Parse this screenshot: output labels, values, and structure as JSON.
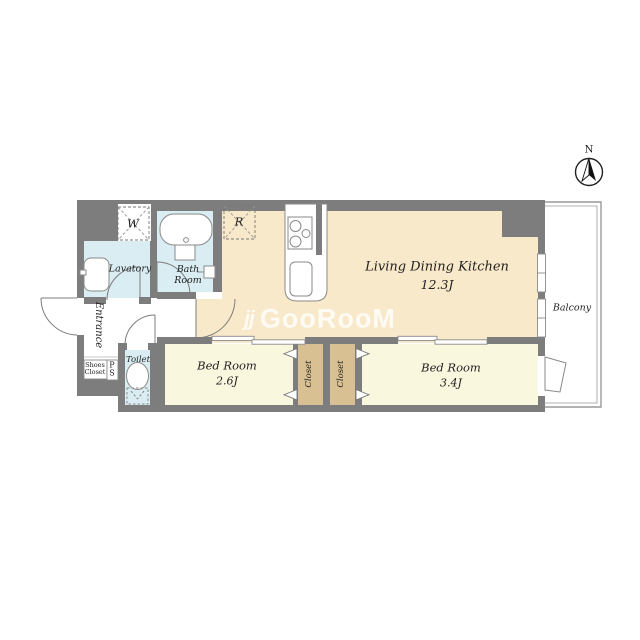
{
  "floorplan": {
    "compass_label": "N",
    "watermark": {
      "icon": "jj",
      "text": "GooRooM"
    },
    "rooms": {
      "ldk": {
        "name": "Living Dining Kitchen",
        "size": "12.3J"
      },
      "bedroom_small": {
        "name": "Bed Room",
        "size": "2.6J"
      },
      "bedroom_large": {
        "name": "Bed Room",
        "size": "3.4J"
      },
      "bath": {
        "name": "Bath Room"
      },
      "lavatory": {
        "name": "Lavatory"
      },
      "toilet": {
        "name": "Toilet"
      },
      "entrance": {
        "name": "Entrance"
      },
      "balcony": {
        "name": "Balcony"
      },
      "closet_left": {
        "name": "Closet"
      },
      "closet_right": {
        "name": "Closet"
      },
      "shoes_closet": {
        "line1": "Shoes",
        "line2": "Closet"
      },
      "pipe_space": {
        "line1": "P",
        "line2": "S"
      }
    },
    "appliances": {
      "washer_label": "W",
      "refrigerator_label": "R"
    },
    "colors": {
      "wall": "#7d7d7d",
      "ldk": "#f9e9cb",
      "bedroom": "#faf7df",
      "closet": "#d9c092",
      "wet_area": "#d9edf3",
      "outline": "#8a8a8a"
    }
  }
}
